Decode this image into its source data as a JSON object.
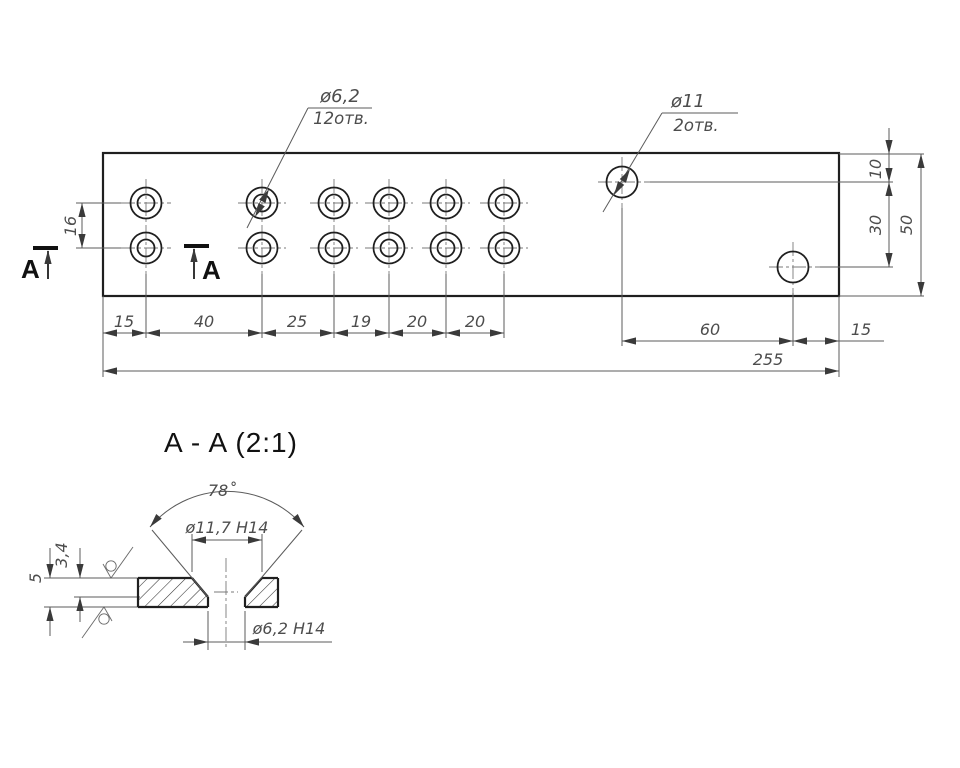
{
  "colors": {
    "outline": "#1f1f1f",
    "thin_lines": "#5b5b5b",
    "dim_text": "#4d4d4d",
    "title_text": "#111111",
    "background": "#ffffff"
  },
  "main_view": {
    "callout_small_hole": {
      "dia": "ø6,2",
      "count": "12отв."
    },
    "callout_large_hole": {
      "dia": "ø11",
      "count": "2отв."
    },
    "section_label_left": "A",
    "section_label_right": "A",
    "dims": {
      "row_spacing": "16",
      "chain": [
        "15",
        "40",
        "25",
        "19",
        "20",
        "20"
      ],
      "dim_60": "60",
      "dim_15_right": "15",
      "overall_length": "255",
      "top_offset": "10",
      "vert_spacing": "30",
      "overall_height": "50"
    }
  },
  "section_view": {
    "title": "A - A (2:1)",
    "dims": {
      "angle": "78˚",
      "csk_dia": "ø11,7 H14",
      "hole_dia": "ø6,2 H14",
      "csk_depth": "3,4",
      "thickness": "5"
    }
  }
}
